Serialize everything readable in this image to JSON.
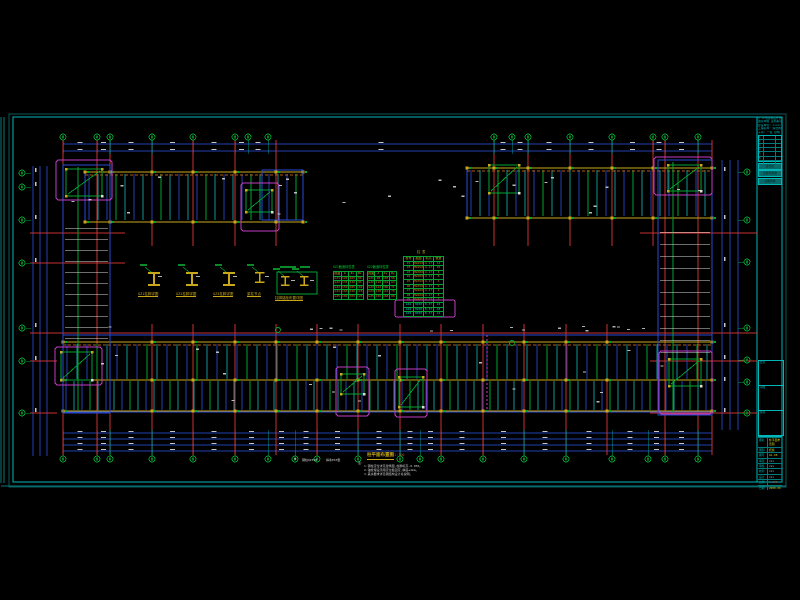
{
  "app": {
    "background": "#000000"
  },
  "colors": {
    "red": "#c83232",
    "blue": "#2a4ad2",
    "teal": "#0f9595",
    "green": "#00a432",
    "yellow": "#c8a818",
    "orange": "#c87818",
    "magenta": "#c43cc4",
    "white": "#dcdcdc",
    "cyan": "#00b7b7",
    "dimblue": "#2440b4",
    "gray": "#9a9a9a"
  },
  "sheet": {
    "outer": [
      9,
      114,
      777,
      373
    ],
    "inner": [
      13,
      117,
      769,
      365
    ],
    "title_divider_x": 757,
    "edge_lines": [
      [
        1,
        117,
        1,
        483
      ],
      [
        4,
        117,
        4,
        483
      ],
      [
        1,
        486,
        786,
        486
      ]
    ]
  },
  "plan": {
    "bubbles": {
      "r": 3.0,
      "top": {
        "y": 137,
        "xs": [
          63,
          97,
          110,
          152,
          193,
          235,
          248,
          268,
          494,
          512,
          528,
          570,
          612,
          653,
          665,
          698
        ]
      },
      "bottom": {
        "y": 459,
        "xs": [
          63,
          97,
          110,
          152,
          193,
          235,
          268,
          295,
          317,
          358,
          400,
          420,
          441,
          483,
          524,
          566,
          612,
          648,
          665,
          698
        ]
      },
      "left": {
        "x": 22,
        "ys": [
          173,
          187,
          220,
          263,
          328,
          361,
          413
        ]
      },
      "right": {
        "x": 747,
        "ys": [
          172,
          220,
          262,
          328,
          360,
          382,
          413
        ]
      }
    },
    "dims": {
      "top": {
        "ys": [
          144,
          151
        ],
        "x1": 63,
        "x2": 712
      },
      "bottom": {
        "ys": [
          433,
          439,
          445,
          451
        ],
        "x1": 63,
        "x2": 712
      },
      "left": {
        "xs": [
          33,
          40,
          47
        ],
        "y1": 166,
        "y2": 456
      },
      "right": {
        "xs": [
          722,
          730,
          738
        ],
        "y1": 160,
        "y2": 430
      }
    },
    "bands": {
      "topLeft": {
        "x": 85,
        "y": 172,
        "w": 218,
        "h": 50,
        "beams": [
          172,
          222
        ],
        "redXs": [
          110,
          152,
          193,
          235,
          276
        ],
        "vstep": 9
      },
      "topRight": {
        "x": 467,
        "y": 168,
        "w": 245,
        "h": 50,
        "beams": [
          168,
          218
        ],
        "redXs": [
          494,
          528,
          570,
          612,
          653
        ],
        "vstep": 9
      },
      "bottom": {
        "x": 63,
        "y": 335,
        "w": 649,
        "h": 77,
        "beams": [
          342,
          380,
          411
        ],
        "redXs": [
          152,
          193,
          235,
          276,
          317,
          358,
          400,
          441,
          483,
          524,
          566,
          607
        ]
      }
    },
    "wings": {
      "left": {
        "x": 63,
        "y": 165,
        "w": 47,
        "h": 248,
        "rungY1": 228,
        "rungY2": 344,
        "rungStep": 11
      },
      "right": {
        "x": 658,
        "y": 160,
        "w": 54,
        "h": 255,
        "rungY1": 232,
        "rungY2": 352,
        "rungStep": 12
      }
    },
    "fullRedXs": [
      63,
      97,
      110,
      665,
      698,
      712
    ],
    "redTop": {
      "y1": 140,
      "y2": 246
    },
    "redBottom": {
      "y1": 324,
      "y2": 455
    },
    "redFull": {
      "y1": 140,
      "y2": 455
    },
    "redHorizontals": [
      [
        30,
        233,
        125
      ],
      [
        640,
        233,
        757
      ],
      [
        30,
        263,
        125
      ],
      [
        30,
        333,
        757
      ],
      [
        650,
        361,
        757
      ],
      [
        650,
        413,
        757
      ],
      [
        30,
        361,
        57
      ],
      [
        30,
        413,
        57
      ]
    ],
    "cores": [
      {
        "m": [
          56,
          160,
          56,
          40
        ],
        "g": [
          66,
          169,
          36,
          27
        ]
      },
      {
        "m": [
          241,
          183,
          38,
          48
        ],
        "g": [
          246,
          190,
          26,
          22
        ],
        "b": [
          262,
          170,
          41,
          50
        ]
      },
      {
        "g": [
          489,
          165,
          30,
          28
        ]
      },
      {
        "m": [
          654,
          157,
          58,
          38
        ],
        "g": [
          668,
          165,
          33,
          26
        ]
      },
      {
        "m": [
          55,
          347,
          47,
          38
        ],
        "g": [
          61,
          352,
          31,
          28
        ]
      },
      {
        "m": [
          336,
          367,
          33,
          49
        ],
        "g": [
          341,
          374,
          23,
          20
        ]
      },
      {
        "m": [
          395,
          369,
          32,
          48
        ],
        "g": [
          399,
          377,
          24,
          30
        ]
      },
      {
        "m": [
          659,
          351,
          53,
          63
        ],
        "g": [
          669,
          359,
          32,
          27
        ]
      }
    ],
    "greenCircles": [
      [
        512,
        343
      ],
      [
        278,
        330
      ]
    ],
    "magentaDashX": 487
  },
  "tables": {
    "a": {
      "x": 333,
      "y": 271,
      "w": 31,
      "h": 25,
      "rows": 6,
      "cols": 4,
      "title": "GZ1截面特性表",
      "cells": [
        "截面",
        "A",
        "Ix",
        "Wx",
        "GZ1",
        "120",
        "460",
        "86",
        "GZ2",
        "135",
        "520",
        "94",
        "GZ3",
        "150",
        "585",
        "102",
        "GZ4",
        "168",
        "640",
        "118",
        "GZ5",
        "180",
        "705",
        "126"
      ]
    },
    "b": {
      "x": 367,
      "y": 271,
      "w": 30,
      "h": 25,
      "rows": 6,
      "cols": 4,
      "title": "GZ2截面特性表",
      "cells": [
        "截面",
        "A",
        "Iy",
        "Wy",
        "GZ1",
        "98",
        "305",
        "58",
        "GZ2",
        "110",
        "342",
        "64",
        "GZ3",
        "124",
        "380",
        "71",
        "GZ4",
        "138",
        "424",
        "79",
        "GZ5",
        "150",
        "468",
        "88"
      ]
    },
    "c": {
      "x": 403,
      "y": 256,
      "w": 41,
      "h": 58,
      "rows": 13,
      "cols": 4,
      "title": "柱 表",
      "cyan_rows": 3,
      "highlight": [
        395,
        300,
        60,
        17
      ],
      "cells": [
        "柱号",
        "截面",
        "标高",
        "数量",
        "Z1",
        "HW250",
        "4.17",
        "12",
        "Z2",
        "HW250",
        "4.17",
        "10",
        "Z3",
        "HW300",
        "4.17",
        "8",
        "Z4",
        "HW300",
        "4.17",
        "8",
        "Z5",
        "HW350",
        "4.17",
        "6",
        "Z6",
        "HW350",
        "4.17",
        "6",
        "Z7",
        "HW400",
        "4.17",
        "4",
        "Z8",
        "HW400",
        "4.17",
        "4",
        "Z9",
        "HW400",
        "4.17",
        "2",
        "GZ1",
        "H200",
        "8.37",
        "24",
        "GZ2",
        "H200",
        "8.37",
        "18",
        "GZ3",
        "H250",
        "8.37",
        "12"
      ]
    }
  },
  "details": {
    "xs": [
      140,
      178,
      215,
      247,
      276
    ],
    "captions": [
      "GZ1柱脚详图",
      "GZ2柱脚详图",
      "GZ3柱脚详图",
      "梁柱节点",
      "柱脚锚栓布置详图"
    ]
  },
  "caption_block": {
    "legend_symbol": "⊕",
    "legend1": "钢柱Q235B",
    "legend2": "焊条E43型",
    "title": "柱平面布置图",
    "scale": "1:100",
    "note_label": "注:",
    "notes": [
      "1.钢柱定位详见建筑图,柱脚标高-0.050。",
      "2.锚栓埋设须用定位板固定,精度±2mm。",
      "3.其余要求详见钢结构设计总说明。"
    ]
  },
  "title_block": {
    "header": [
      "□ ××市建筑设计研究院",
      "国家甲级  证书编号 A-123",
      "建设单位: ×××××",
      "工程名称: 综合教学楼",
      "子项: 一区  结构"
    ],
    "rev_rows": 7,
    "bars": [
      "会签栏",
      "出图专用章",
      "注册师章"
    ],
    "boxes": [
      "会签",
      "审图",
      "备案"
    ],
    "bottom_rows": [
      {
        "l": "图名",
        "v": "柱平面布置图",
        "c": "#c8c818"
      },
      {
        "l": "图别",
        "v": "结施",
        "c": "#c8c818"
      },
      {
        "l": "图号",
        "v": "GS-08",
        "c": "#c8c818"
      },
      {
        "l": "审定",
        "v": "×××",
        "c": ""
      },
      {
        "l": "审核",
        "v": "×××",
        "c": ""
      },
      {
        "l": "校对",
        "v": "×××",
        "c": ""
      },
      {
        "l": "设计",
        "v": "×××",
        "c": ""
      },
      {
        "l": "比例",
        "v": "1:100",
        "c": "#c84040"
      },
      {
        "l": "日期",
        "v": "2008.06",
        "c": "#c8c818"
      }
    ]
  }
}
